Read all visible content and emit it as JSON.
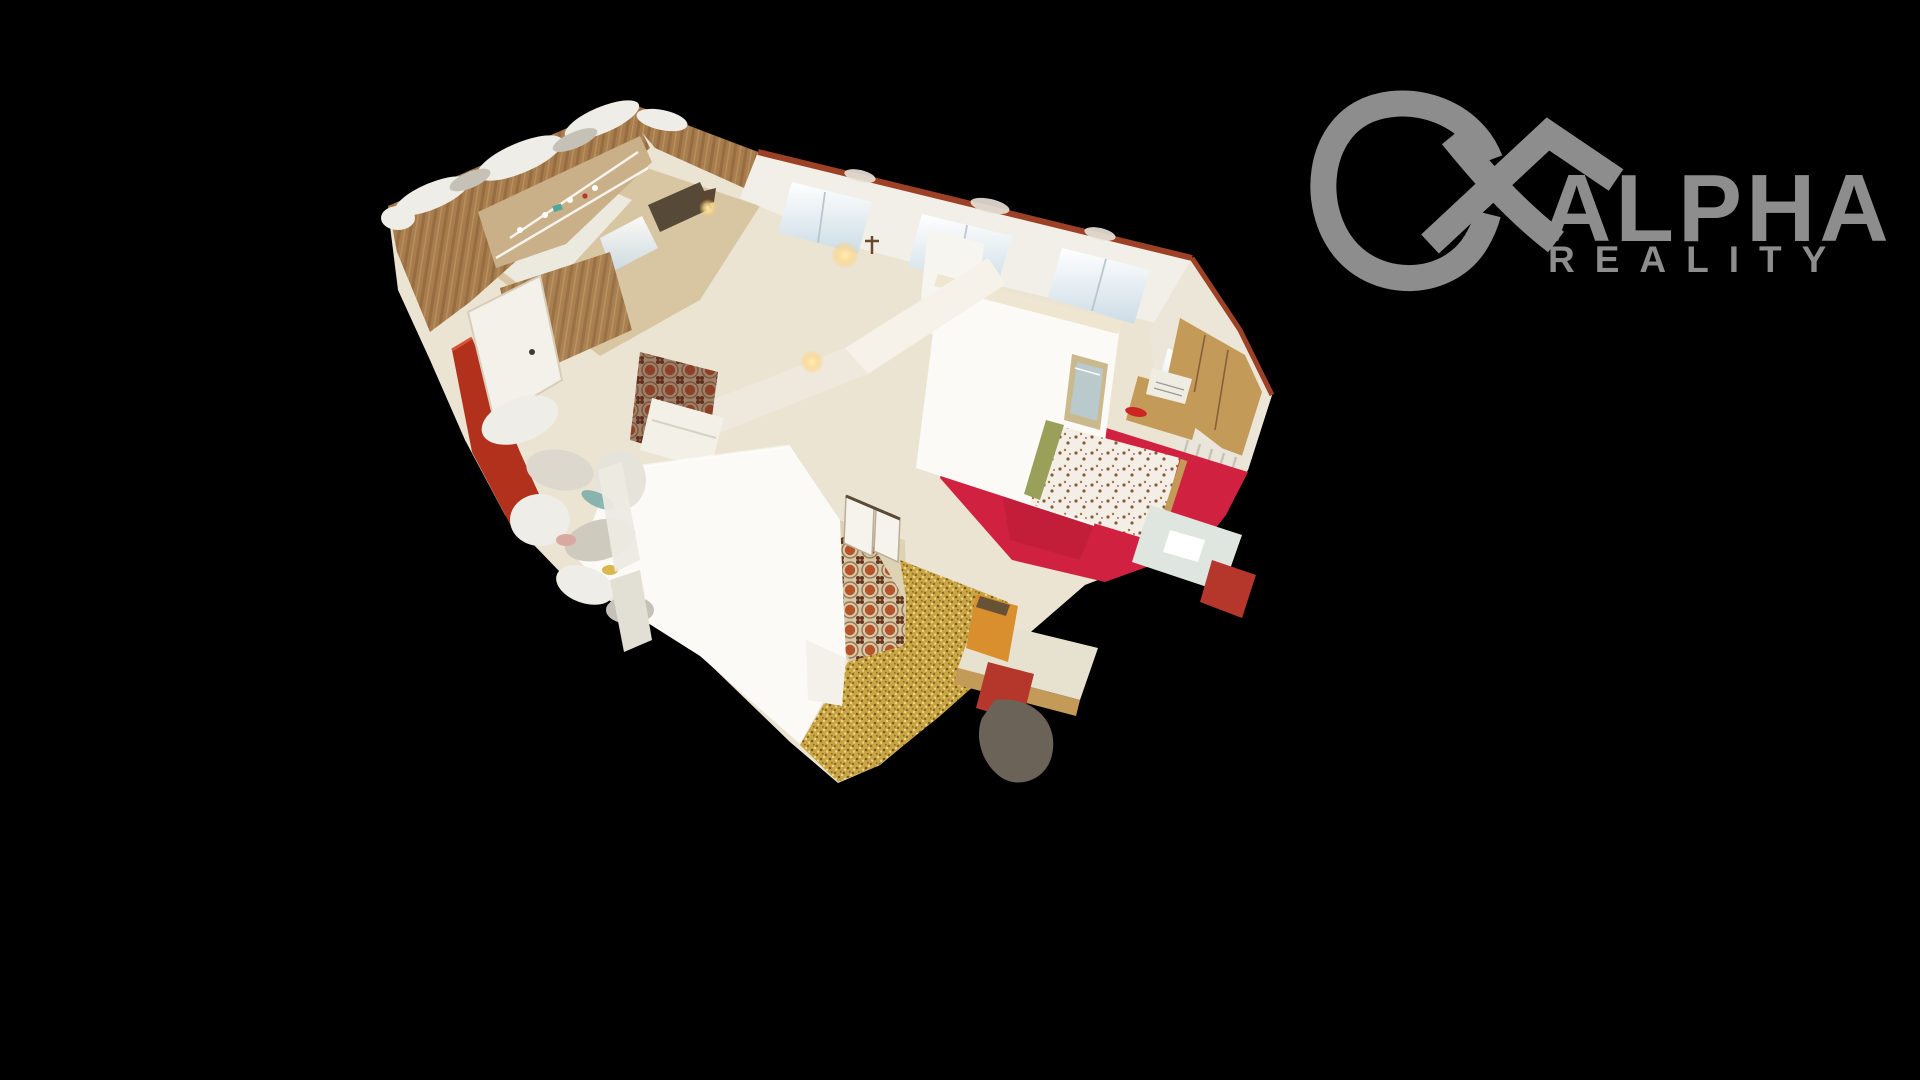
{
  "window": {
    "width": 1920,
    "height": 1080
  },
  "logo": {
    "line1": "ALPHA",
    "line2": "REALITY",
    "symbol": "alpha-house",
    "color": "#8d8d8d"
  },
  "scene": {
    "kind": "3d-dollhouse-cutaway-scan",
    "description": "Top-down cutaway 3D scan of an apartment on black background",
    "rooms": [
      {
        "name": "kitchen",
        "floor": "tan-wood",
        "walls": "wood-paneling-with-shelves"
      },
      {
        "name": "hallway",
        "floor": "orange-patterned-runner"
      },
      {
        "name": "bedroom-red",
        "floor": "red-carpet",
        "items": [
          "bed-floral-duvet",
          "nightstand",
          "typewriter",
          "radiator",
          "picture-frame",
          "desk",
          "red-chair",
          "wardrobe"
        ]
      },
      {
        "name": "bedroom-yellow",
        "floor": "yellow-speckled-carpet",
        "items": [
          "desk",
          "orange-cabinet",
          "red-chair"
        ]
      },
      {
        "name": "small-room",
        "floor": "dark-ornate-rug",
        "items": [
          "white-couch",
          "wood-wardrobe"
        ]
      }
    ],
    "colors": {
      "bg": "#000000",
      "logo": "#8d8d8d",
      "base": "#ece4d2",
      "wall_white": "#fbfaf6",
      "wall_cream": "#efe6d2",
      "wood": "#a97c4b",
      "wood_dark": "#86603a",
      "wood_light": "#c9b088",
      "floor_tan": "#d8c6a2",
      "red_carpet": "#d02240",
      "red_carpet_dark": "#a81830",
      "yellow": "#c9a544",
      "yellow_dark": "#7a5c20",
      "yellow_light": "#ecd98e",
      "runner_bg": "#d8c8a4",
      "runner_rust": "#b5532a",
      "runner_dark": "#63341f",
      "trim": "#9c4126",
      "red_wall": "#b2311c",
      "glow": "#ffd98a",
      "artifact_white": "#efede7",
      "artifact_gray": "#c6c1b6",
      "furn_wood": "#c49a58",
      "chair_red": "#b5372c",
      "cabinet_orange": "#d98f2e",
      "blob_dark": "#6b6258"
    }
  }
}
